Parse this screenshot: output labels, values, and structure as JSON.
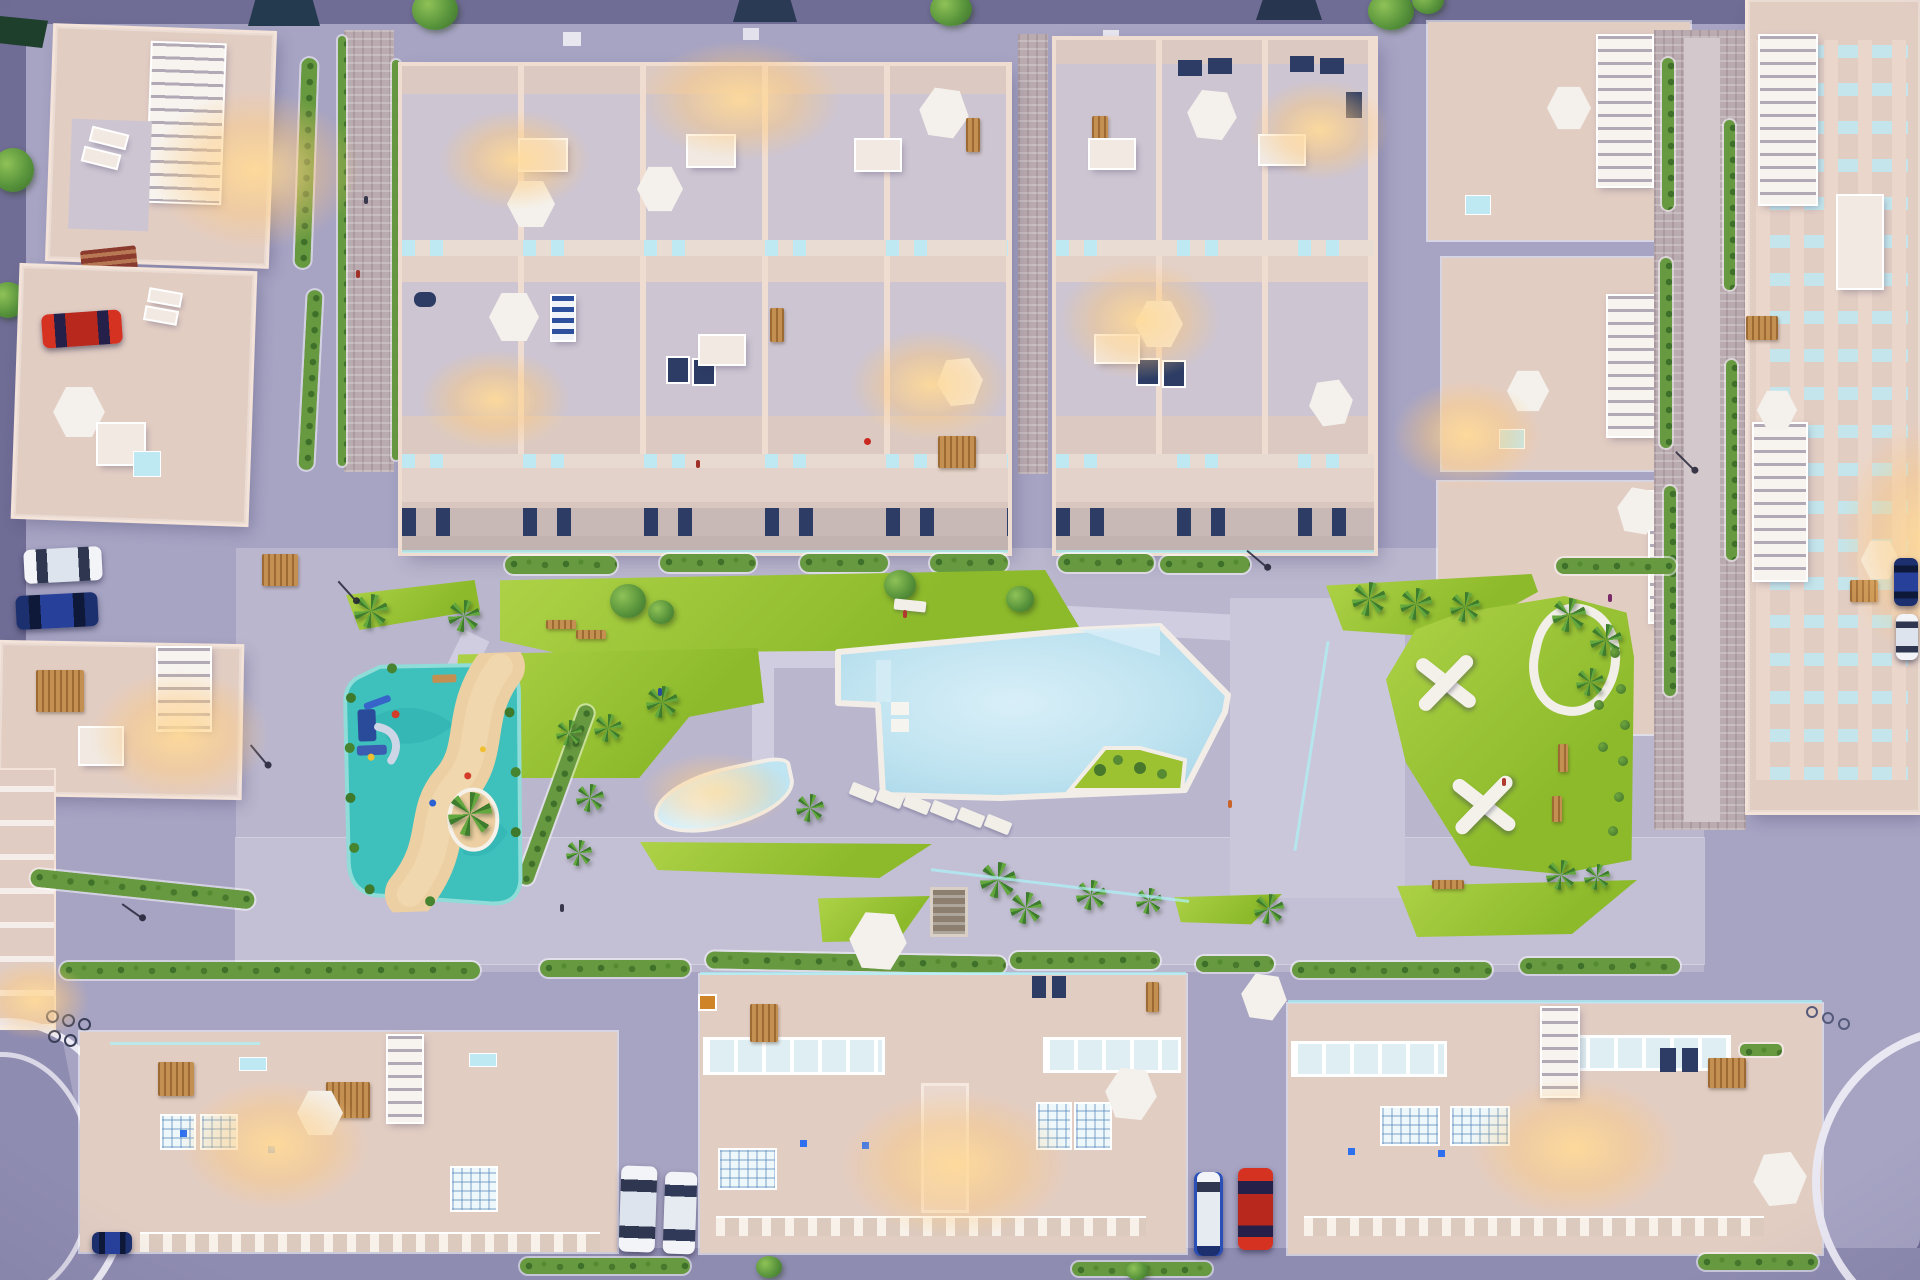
{
  "scene": {
    "type": "aerial-3d-architectural-render",
    "setting": "residential complex with central pool courtyard at dusk",
    "camera": "top-down bird's eye view",
    "lighting": [
      "purple dusk ambient",
      "warm glowing roof terraces",
      "cyan LED edge strips",
      "glowing kids pool"
    ]
  },
  "palette": {
    "outer": "#6f6c95",
    "street": "#a6a3c3",
    "street_dark": "#8f8cb1",
    "deck": "#bab6ce",
    "promenade": "#c3bfd5",
    "path": "#d1cde0",
    "brick": "#b9abaf",
    "bldg": "#e2cdc3",
    "bldg_wall": "#f3e3d9",
    "terrace": "#cdc5d1",
    "roof": "#dcc9c1",
    "white_trim": "#f6f2ec",
    "lawn": "#a2cb38",
    "hedge": "#679a40",
    "pool": "#b6ddec",
    "pool_light": "#d8eff8",
    "pool_rim": "#f2eee7",
    "play_teal": "#3ec0bd",
    "play_sand": "#eccfa2",
    "umbrella": "#f4f1ec",
    "skylight": "#bfe9f2",
    "navy": "#2c3c64",
    "glow": "#ffd9a0",
    "led": "#aef0f4",
    "car_red": "#d63222",
    "car_white": "#f2f4f8",
    "car_navy": "#1c2f6e",
    "tree": "#5e9a3c",
    "palm": "#4e9038",
    "wood": "#c49052"
  },
  "inventory": {
    "building_groups": [
      "detached-houses-left-column",
      "townhouse-block-top-left",
      "townhouse-block-top-right",
      "apartment-blocks-right-edge",
      "terrace-blocks-bottom-row"
    ],
    "amenities": [
      "main-swimming-pool",
      "glowing-kids-pool",
      "teal-splash-playground-with-sand-river",
      "central-lawns",
      "palm-triangle-island",
      "x-bench-garden",
      "pedestrian-promenade",
      "brick-walkways"
    ],
    "vehicles": [
      {
        "name": "red-car-left-street",
        "color": "#d63222"
      },
      {
        "name": "white-car-left-street",
        "color": "#f2f4f8"
      },
      {
        "name": "navy-car-left-street",
        "color": "#1c2f6e"
      },
      {
        "name": "white-car-bottom-alley-1",
        "color": "#f2f4f8"
      },
      {
        "name": "white-car-bottom-alley-2",
        "color": "#f2f4f8"
      },
      {
        "name": "white-van-bottom-alley",
        "color": "#f2f4f8"
      },
      {
        "name": "red-car-bottom-alley",
        "color": "#d63222"
      },
      {
        "name": "navy-car-right-street",
        "color": "#1c2f6e"
      },
      {
        "name": "white-car-right-street",
        "color": "#f2f4f8"
      },
      {
        "name": "navy-car-bottom-left-corner",
        "color": "#1c2f6e"
      }
    ],
    "landscape_counts": {
      "palm_trees": 28,
      "round_trees": 10,
      "hedge_strips": 22,
      "white_umbrellas": 17,
      "lit_terraces": 14,
      "bicycle_rack_bikes": 6
    }
  }
}
